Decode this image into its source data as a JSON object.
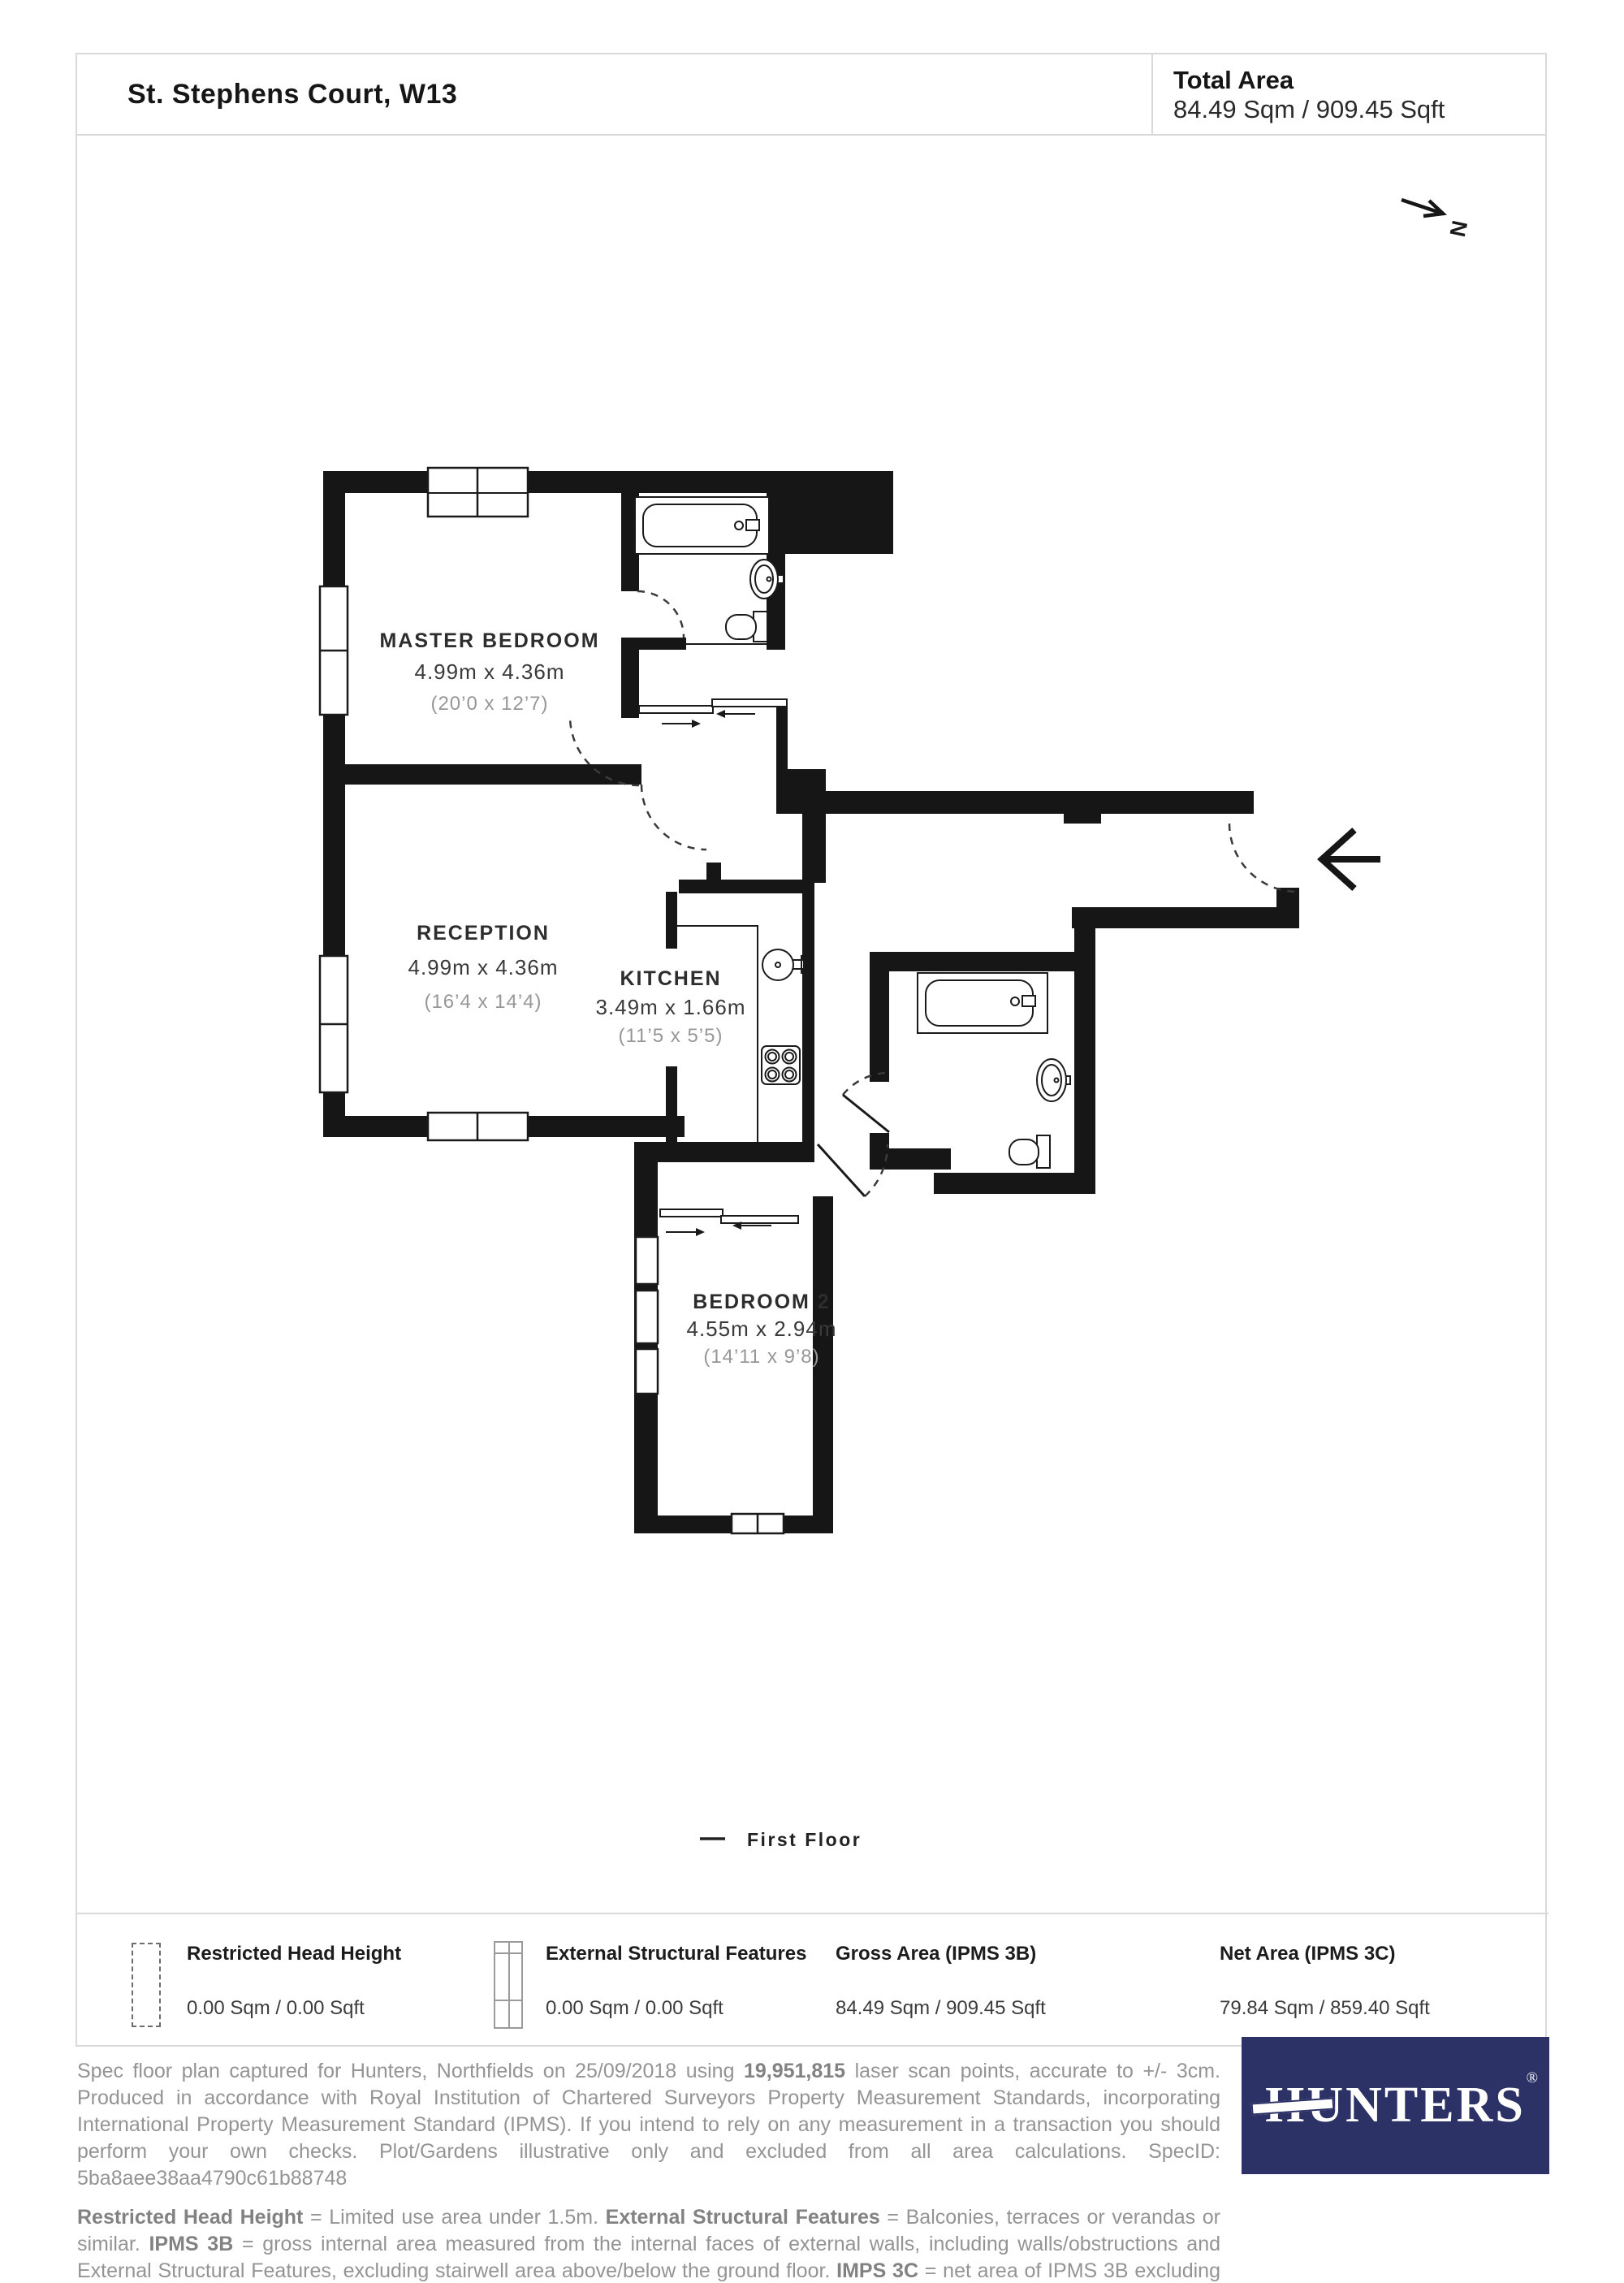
{
  "header": {
    "title": "St. Stephens Court, W13",
    "total_area_label": "Total Area",
    "total_area_value": "84.49 Sqm / 909.45 Sqft"
  },
  "north": {
    "letter": "N"
  },
  "floor": {
    "label": "First Floor"
  },
  "rooms": [
    {
      "name": "MASTER BEDROOM",
      "metric": "4.99m x 4.36m",
      "imperial": "(20’0 x 12’7)"
    },
    {
      "name": "RECEPTION",
      "metric": "4.99m x 4.36m",
      "imperial": "(16’4 x 14’4)"
    },
    {
      "name": "KITCHEN",
      "metric": "3.49m x 1.66m",
      "imperial": "(11’5 x 5’5)"
    },
    {
      "name": "BEDROOM 2",
      "metric": "4.55m x 2.94m",
      "imperial": "(14’11 x 9’8)"
    }
  ],
  "legend": {
    "items": [
      {
        "title": "Restricted Head Height",
        "value": "0.00 Sqm / 0.00 Sqft"
      },
      {
        "title": "External Structural Features",
        "value": "0.00 Sqm / 0.00 Sqft"
      },
      {
        "title": "Gross Area (IPMS 3B)",
        "value": "84.49 Sqm / 909.45 Sqft"
      },
      {
        "title": "Net Area (IPMS 3C)",
        "value": "79.84 Sqm / 859.40 Sqft"
      }
    ]
  },
  "footer": {
    "para1": [
      {
        "t": "Spec floor plan captured for Hunters, Northfields on 25/09/2018 using "
      },
      {
        "t": "19,951,815",
        "b": true
      },
      {
        "t": " laser scan points, accurate to +/- 3cm. Produced in accordance with Royal Institution of Chartered Surveyors Property Measurement Standards, incorporating International Property Measurement Standard (IPMS). If you intend to rely on any measurement in a transaction you should perform your own checks. Plot/Gardens illustrative only and excluded from all area calculations. SpecID: 5ba8aee38aa4790c61b88748"
      }
    ],
    "para2": [
      {
        "t": "Restricted Head Height",
        "b": true
      },
      {
        "t": " = Limited use area under 1.5m. "
      },
      {
        "t": "External Structural Features",
        "b": true
      },
      {
        "t": " = Balconies, terraces or verandas or similar. "
      },
      {
        "t": "IPMS 3B",
        "b": true
      },
      {
        "t": " = gross internal area measured from the internal faces of external walls, including walls/obstructions and External Structural Features, excluding stairwell area above/below the ground floor. "
      },
      {
        "t": "IMPS 3C",
        "b": true
      },
      {
        "t": " = net area of IPMS 3B excluding internal walls/obstructions and stairwell area above/below the ground floor. "
      },
      {
        "t": "Total Area",
        "b": true
      },
      {
        "t": " = IPMS 3B gross area + stairwell area above/below ground floor of 0.00 Sqm / 0.00 Sqft."
      }
    ]
  },
  "logo": {
    "text": "HUNTERS",
    "reg": "®",
    "color": "#2c3166"
  },
  "colors": {
    "wall": "#161616",
    "frame_border": "#d9d9d9",
    "muted_text": "#949494",
    "logo_navy": "#2c3166"
  }
}
